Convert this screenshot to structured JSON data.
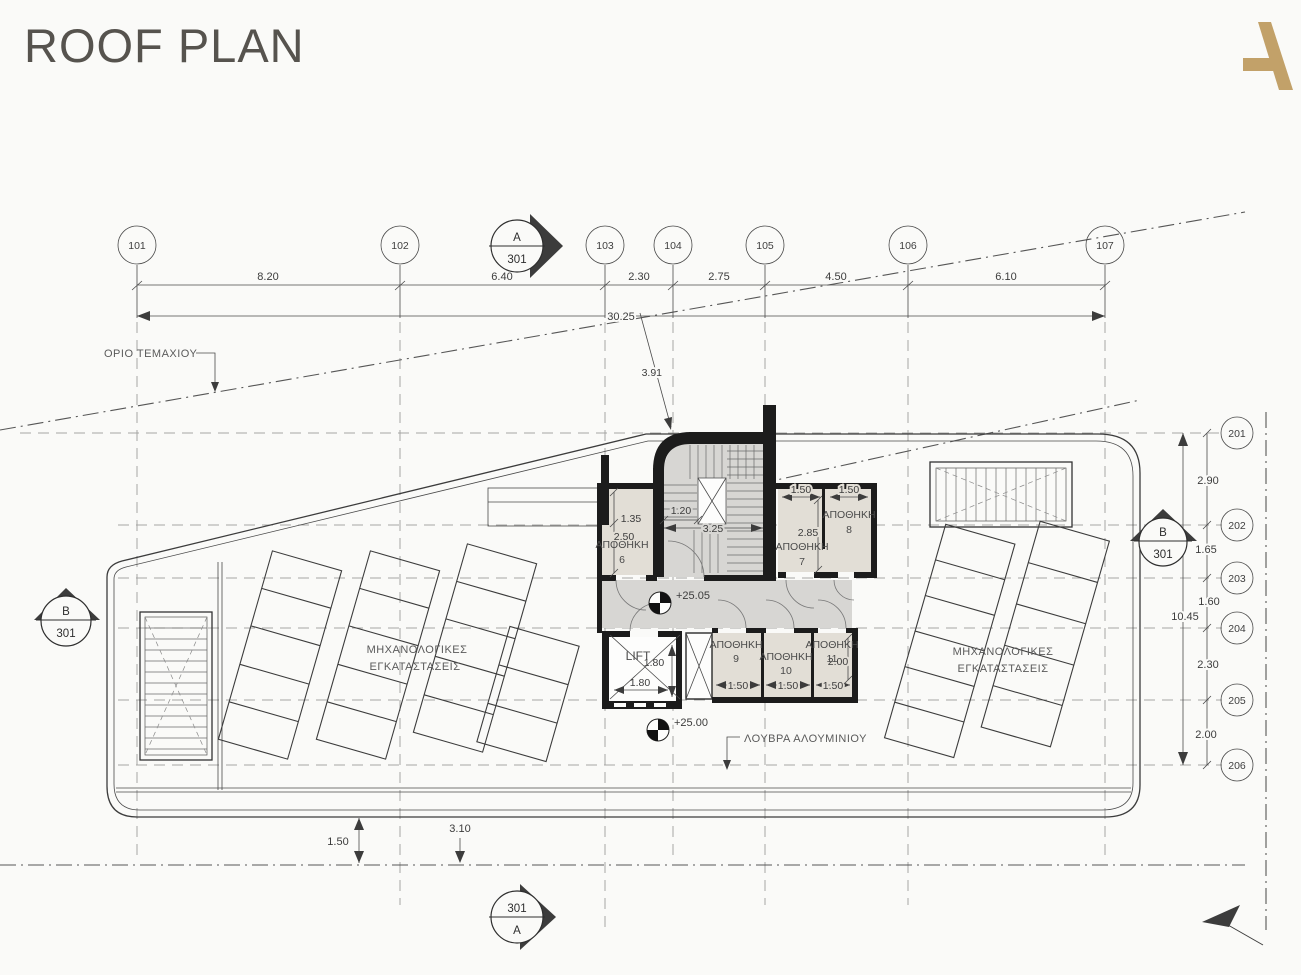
{
  "header": {
    "title": "ROOF PLAN"
  },
  "colors": {
    "accent_gold": "#c2a169",
    "wall_black": "#1c1c1c",
    "room_fill": "#e2ded6",
    "stair_fill": "#d7d6d3",
    "line": "#4a4a4a"
  },
  "grid": {
    "top": {
      "bubbles": [
        {
          "label": "101"
        },
        {
          "label": "102"
        },
        {
          "label": "103"
        },
        {
          "label": "104"
        },
        {
          "label": "105"
        },
        {
          "label": "106"
        },
        {
          "label": "107"
        }
      ],
      "dims": [
        "8.20",
        "6.40",
        "2.30",
        "2.75",
        "4.50",
        "6.10"
      ],
      "overall": "30.25"
    },
    "right": {
      "bubbles": [
        {
          "label": "201"
        },
        {
          "label": "202"
        },
        {
          "label": "203"
        },
        {
          "label": "204"
        },
        {
          "label": "205"
        },
        {
          "label": "206"
        }
      ],
      "dims": [
        "2.90",
        "1.65",
        "1.60",
        "2.30",
        "2.00"
      ],
      "overall": "10.45"
    }
  },
  "section_markers": {
    "top": {
      "letter": "A",
      "sheet": "301"
    },
    "left": {
      "letter": "B",
      "sheet": "301"
    },
    "right": {
      "letter": "B",
      "sheet": "301"
    },
    "bottom": {
      "sheet": "301",
      "letter": "A"
    }
  },
  "levels": {
    "upper": "+25.05",
    "lower": "+25.00"
  },
  "annotations": {
    "site_boundary": "ΟΡΙΟ ΤΕΜΑΧΙΟΥ",
    "louvers": "ΛΟΥΒΡΑ ΑΛΟΥΜΙΝΙΟΥ",
    "mech_line1": "ΜΗΧΑΝΟΛΟΓΙΚΕΣ",
    "mech_line2": "ΕΓΚΑΤΑΣΤΑΣΕΙΣ"
  },
  "rooms": {
    "s6": {
      "name": "ΑΠΟΘΗΚΗ",
      "number": "6"
    },
    "s7": {
      "name": "ΑΠΟΘΗΚΗ",
      "number": "7"
    },
    "s8": {
      "name": "ΑΠΟΘΗΚΗ",
      "number": "8"
    },
    "s9": {
      "name": "ΑΠΟΘΗΚΗ",
      "number": "9"
    },
    "s10": {
      "name": "ΑΠΟΘΗΚΗ",
      "number": "10"
    },
    "s11": {
      "name": "ΑΠΟΘΗΚΗ",
      "number": "11"
    },
    "lift": {
      "label": "LIFT"
    }
  },
  "plan_dims": {
    "stair_offset": "3.91",
    "s6_inner": "1.35",
    "s6_depth": "2.50",
    "stair_flight": "1.20",
    "stair_width": "3.25",
    "s7_width": "1.50",
    "s8_width": "1.50",
    "s7_depth": "2.85",
    "lift_width": "1.80",
    "lift_depth": "1.80",
    "s9_width": "1.50",
    "s10_width": "1.50",
    "s11_width": "1.50",
    "s11_depth": "2.00",
    "south_offset": "1.50",
    "south_gap": "3.10"
  }
}
